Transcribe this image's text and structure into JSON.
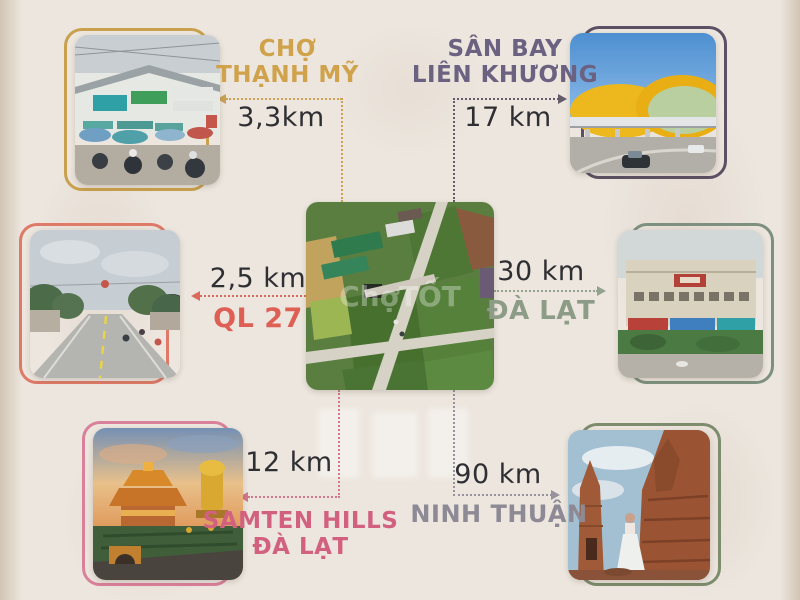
{
  "canvas": {
    "background": "#ece6de"
  },
  "center_image": {
    "description": "aerial-view-of-subdivided-land-plots",
    "watermark": "ChợTỐT"
  },
  "locations": [
    {
      "id": "cho-thanh-my",
      "title": "CHỢ\nTHẠNH MỸ",
      "distance": "3,3km",
      "accent": "#cfa24b",
      "position": "top-left",
      "photo": "street-market"
    },
    {
      "id": "san-bay-lien-khuong",
      "title": "SÂN BAY\nLIÊN KHƯƠNG",
      "distance": "17 km",
      "accent": "#6b6180",
      "position": "top-right",
      "photo": "airport-terminal"
    },
    {
      "id": "ql-27",
      "title": "QL 27",
      "distance": "2,5 km",
      "accent": "#de5f54",
      "position": "middle-left",
      "photo": "highway-road"
    },
    {
      "id": "da-lat",
      "title": "ĐÀ LẠT",
      "distance": "30 km",
      "accent": "#8c9c87",
      "position": "middle-right",
      "photo": "dalat-market-building"
    },
    {
      "id": "samten-hills",
      "title": "SAMTEN HILLS\nĐÀ LẠT",
      "distance": "12 km",
      "accent": "#d2617f",
      "position": "bottom-left",
      "photo": "samten-hills-temple"
    },
    {
      "id": "ninh-thuan",
      "title": "NINH THUẬN",
      "distance": "90 km",
      "accent": "#8d8a96",
      "position": "bottom-right",
      "photo": "cham-towers"
    }
  ]
}
